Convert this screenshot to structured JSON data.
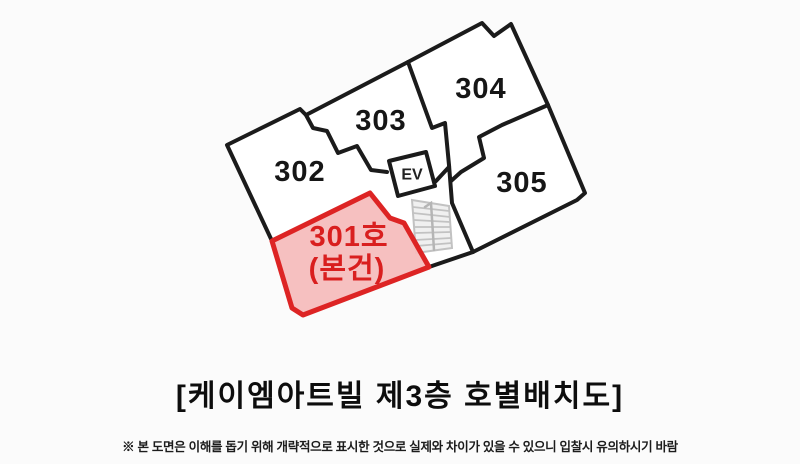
{
  "title": "[케이엠아트빌 제3층 호별배치도]",
  "footnote": "※ 본 도면은 이해를 돕기 위해 개략적으로 표시한 것으로 실제와 차이가 있을 수 있으니 입찰시 유의하시기 바람",
  "floor_plan": {
    "type": "building-unit-layout",
    "elevator_label": "EV",
    "units": [
      {
        "id": "301",
        "label": "301호",
        "sublabel": "(본건)",
        "highlighted": true
      },
      {
        "id": "302",
        "label": "302",
        "highlighted": false
      },
      {
        "id": "303",
        "label": "303",
        "highlighted": false
      },
      {
        "id": "304",
        "label": "304",
        "highlighted": false
      },
      {
        "id": "305",
        "label": "305",
        "highlighted": false
      }
    ],
    "colors": {
      "wall": "#1b1b1b",
      "highlight_stroke": "#dd2424",
      "highlight_fill": "#f6bdbd",
      "highlight_text": "#d91f1f",
      "stairs": "#c2c2c2",
      "background": "#fbfbfb"
    }
  }
}
